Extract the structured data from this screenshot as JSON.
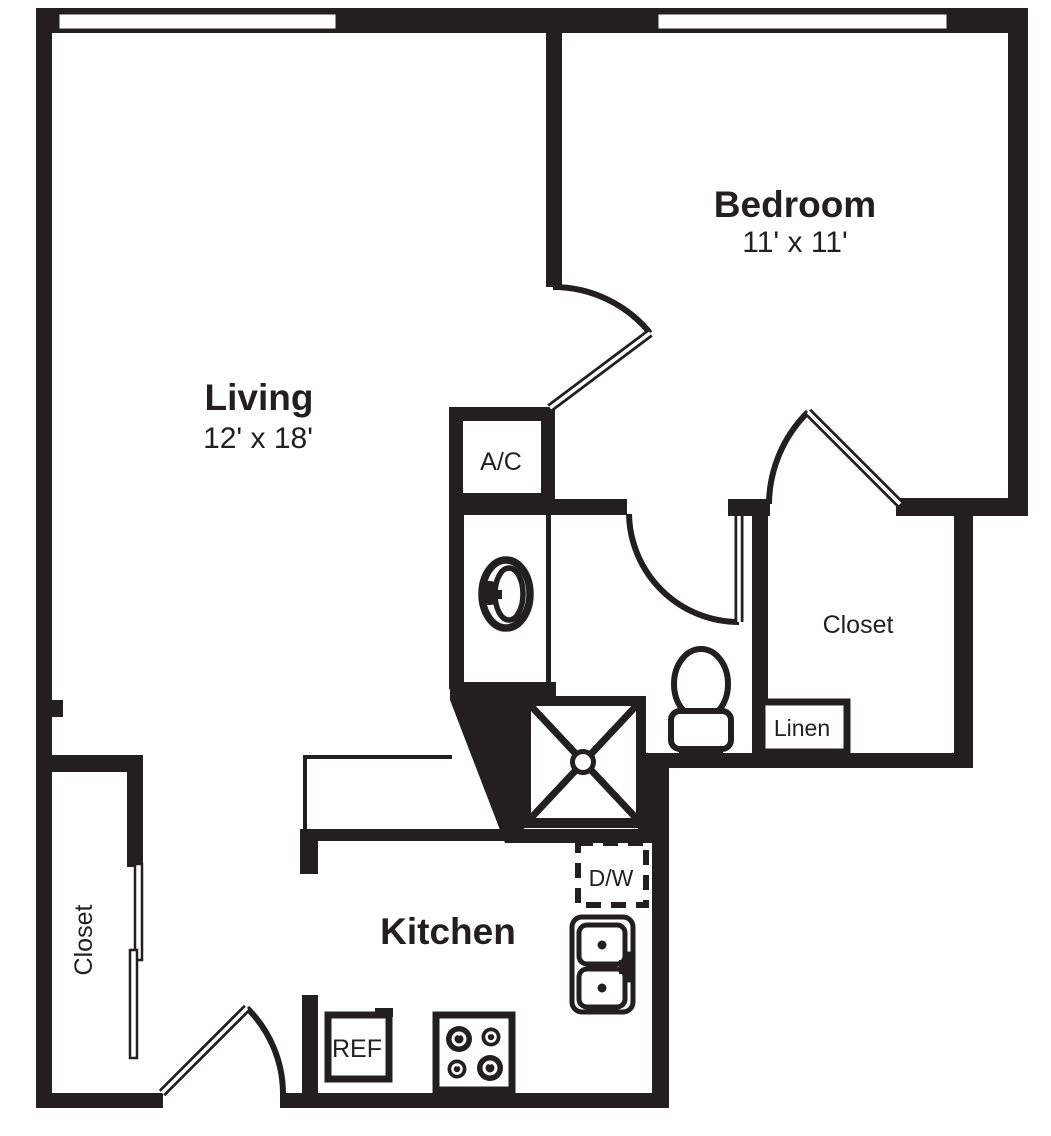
{
  "colors": {
    "ink": "#231f20",
    "background": "#ffffff"
  },
  "rooms": {
    "living": {
      "label": "Living",
      "dimensions": "12' x 18'"
    },
    "bedroom": {
      "label": "Bedroom",
      "dimensions": "11' x 11'"
    },
    "kitchen": {
      "label": "Kitchen"
    },
    "bedroom_closet": {
      "label": "Closet"
    },
    "entry_closet": {
      "label": "Closet"
    }
  },
  "fixtures": {
    "ac": {
      "label": "A/C"
    },
    "linen": {
      "label": "Linen"
    },
    "refrigerator": {
      "label": "REF"
    },
    "dishwasher": {
      "label": "D/W"
    }
  }
}
